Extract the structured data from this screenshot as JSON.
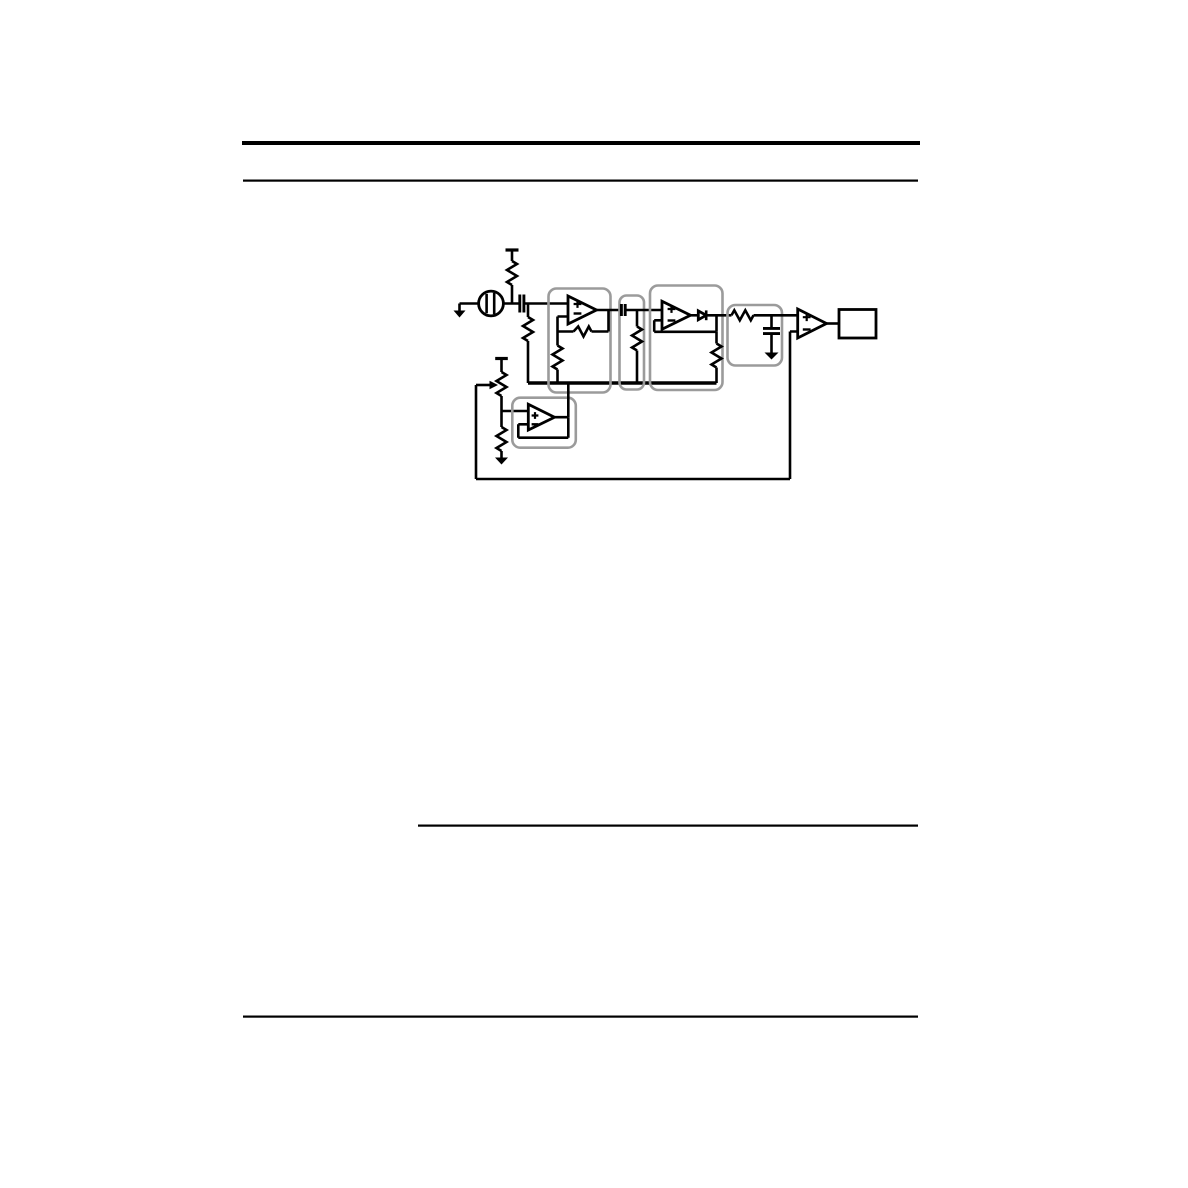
{
  "page": {
    "background_color": "#ffffff",
    "ink_color": "#000000",
    "group_outline_color": "#9b9b9b",
    "horizontal_rule_count": 4,
    "visible_text": ""
  },
  "figure": {
    "kind": "circuit-schematic",
    "label": "Schematic: electret microphone, amplifier stage, high-pass filter, rectifier stage, envelope low-pass filter, comparator and output block with buffered reference bus and threshold potentiometer",
    "components": {
      "supply_rail": "V+ supply bar with microphone bias resistor",
      "microphone": "electret microphone capsule",
      "mic_ground": "ground symbol at microphone return",
      "coupling_capacitor": "series input coupling capacitor",
      "input_bias_resistor": "input bias resistor to reference bus",
      "stage1": "non-inverting amplifier stage (op-amp with feedback resistor and gain resistor to reference bus)",
      "highpass_filter": "high-pass filter block: series capacitor with shunt resistor to reference bus",
      "stage2": "amplifier stage with half-wave rectifier diode and feedback, resistor to reference bus",
      "lowpass_filter": "envelope low-pass filter block: series resistor with shunt capacitor to ground",
      "comparator": "output comparator op-amp",
      "output_block": "output box",
      "reference_bus": "buffered reference voltage bus",
      "reference_buffer": "unity-gain buffer op-amp for reference voltage",
      "threshold_potentiometer": "threshold-setting potentiometer from V+ with lower divider resistor to ground",
      "threshold_line": "wiper line routed to comparator inverting input"
    }
  }
}
